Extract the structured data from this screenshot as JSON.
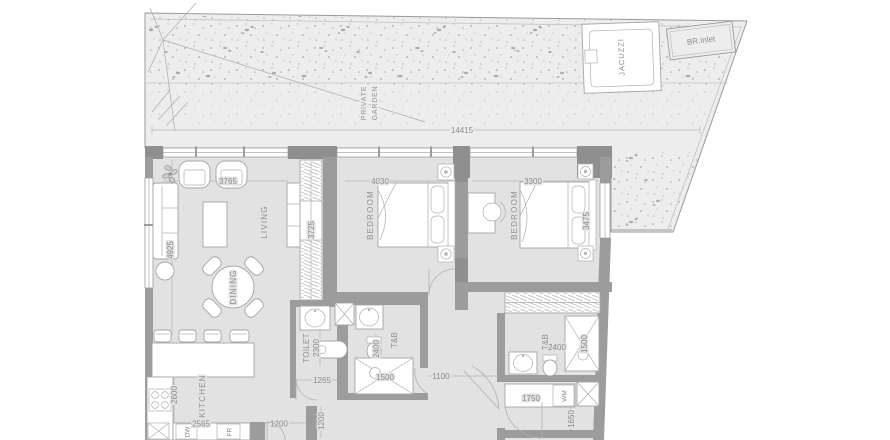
{
  "garden": {
    "label": [
      "PRIVATE",
      "GARDEN"
    ],
    "dim_width": "14415",
    "jacuzzi": "JACUZZI",
    "br_inlet": "BR.Inlet"
  },
  "rooms": {
    "living": {
      "label": "LIVING",
      "dim_top": "3765",
      "dim_left": "4925",
      "dim_wardrobe": "3725"
    },
    "dining": {
      "label": "DINING"
    },
    "kitchen": {
      "label": "KITCHEN",
      "dim_left": "2600",
      "dim_bottom": "2565",
      "dim_pass": "1200",
      "dim_hall": "1200",
      "appliance_dw": "DW",
      "appliance_fr": "FR"
    },
    "bedroom1": {
      "label": "BEDROOM",
      "dim_top": "4030"
    },
    "bedroom2": {
      "label": "BEDROOM",
      "dim_top": "3300",
      "dim_right": "3475"
    },
    "toilet": {
      "label": "TOILET",
      "dim_depth": "2300",
      "dim_width": "1265"
    },
    "bath1": {
      "label": "T&B",
      "dim_depth": "2400",
      "dim_width": "1500"
    },
    "corridor": {
      "dim": "1100"
    },
    "bath2": {
      "label": "T&B",
      "dim": "2400",
      "dim_shower": "1500"
    },
    "laundry": {
      "dim_width": "1750",
      "appliance_wm": "WM",
      "dim_depth": "1650"
    }
  },
  "colors": {
    "floor": "#e2e2e2",
    "garden": "#ededed",
    "wall": "#9c9c9c",
    "text": "#8a8a8a"
  }
}
